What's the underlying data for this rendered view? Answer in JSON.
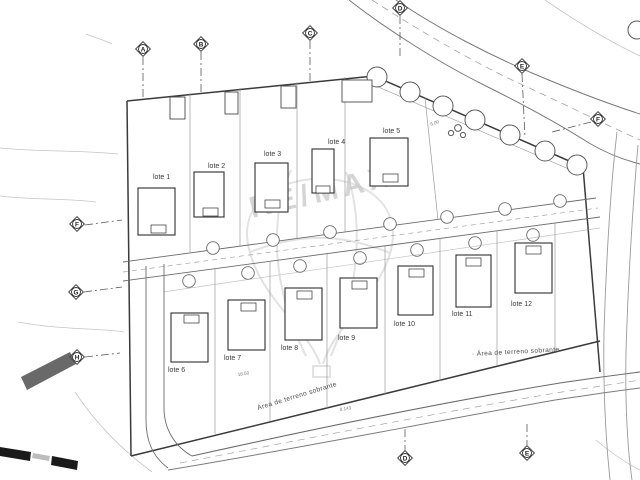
{
  "annotations": {
    "watermark": "RE/MAX",
    "surplus_area_1": "Área de terreno sobrante",
    "surplus_area_2": "· Área de terreno sobrante"
  },
  "lots": [
    {
      "label": "lote 1"
    },
    {
      "label": "lote 2"
    },
    {
      "label": "lote 3"
    },
    {
      "label": "lote 4"
    },
    {
      "label": "lote 5"
    },
    {
      "label": "lote 6"
    },
    {
      "label": "lote 7"
    },
    {
      "label": "lote 8"
    },
    {
      "label": "lote 9"
    },
    {
      "label": "lote 10"
    },
    {
      "label": "lote 11"
    },
    {
      "label": "lote 12"
    }
  ],
  "markers": [
    {
      "letter": "A"
    },
    {
      "letter": "B"
    },
    {
      "letter": "C"
    },
    {
      "letter": "D"
    },
    {
      "letter": "E"
    },
    {
      "letter": "F"
    },
    {
      "letter": "F"
    },
    {
      "letter": "G"
    },
    {
      "letter": "H"
    },
    {
      "letter": "D"
    },
    {
      "letter": "E"
    }
  ],
  "dimensions": [
    {
      "value": "5.00"
    },
    {
      "value": "8.143"
    },
    {
      "value": "18.50"
    }
  ],
  "colors": {
    "line_dark": "#3a3a3a",
    "line_mid": "#6b6b6b",
    "line_light": "#9a9a9a",
    "watermark": "#c7c7c7",
    "hatch_fill": "#4f4f4f"
  }
}
